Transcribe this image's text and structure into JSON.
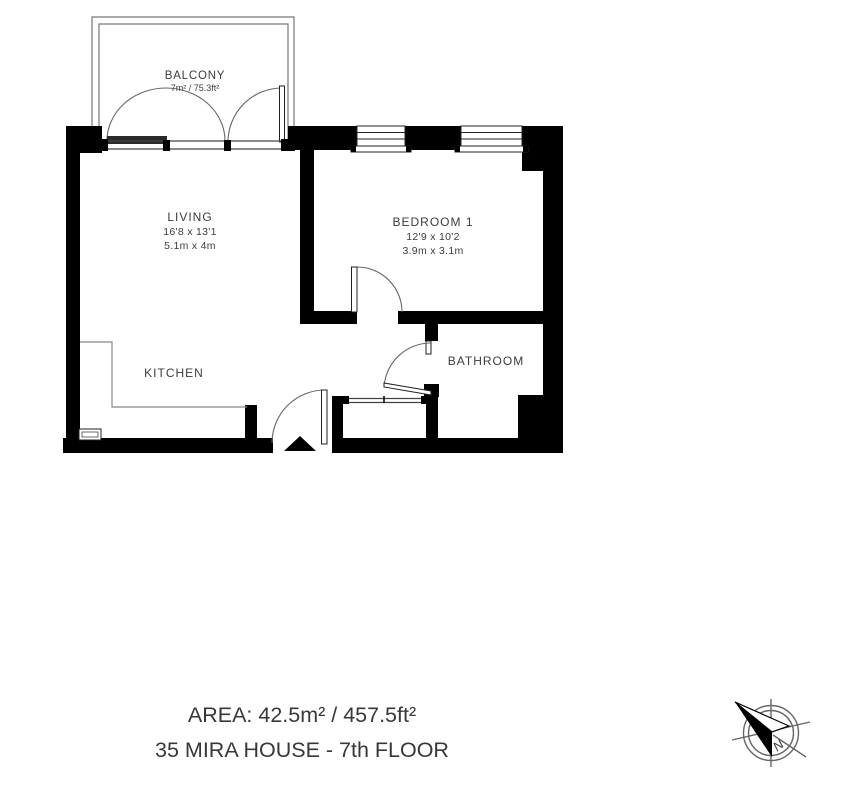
{
  "rooms": {
    "balcony": {
      "label": "BALCONY",
      "area": "7m² / 75.3ft²"
    },
    "living": {
      "label": "LIVING",
      "dimensions_imperial": "16'8 x 13'1",
      "dimensions_metric": "5.1m x 4m"
    },
    "bedroom1": {
      "label": "BEDROOM 1",
      "dimensions_imperial": "12'9 x 10'2",
      "dimensions_metric": "3.9m x 3.1m"
    },
    "kitchen": {
      "label": "KITCHEN"
    },
    "bathroom": {
      "label": "BATHROOM"
    }
  },
  "footer": {
    "area_line": "AREA: 42.5m² / 457.5ft²",
    "address_line": "35 MIRA HOUSE - 7th FLOOR"
  },
  "compass": {
    "north_label": "N"
  },
  "colors": {
    "wall": "#000000",
    "text": "#3c3c3c",
    "thin_line": "#777777"
  }
}
